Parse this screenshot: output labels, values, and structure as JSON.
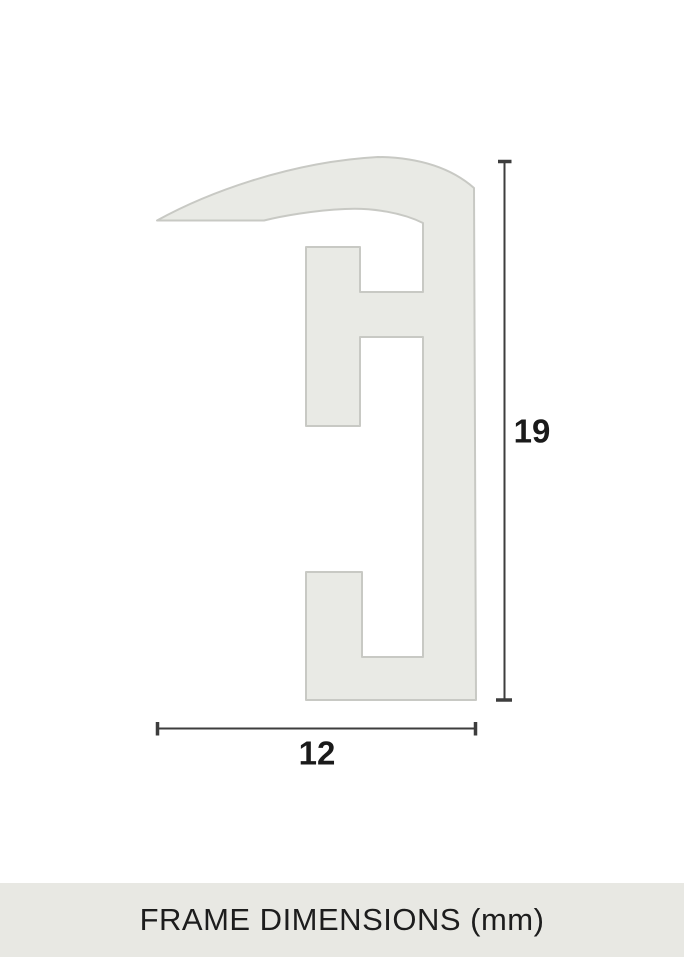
{
  "diagram": {
    "caption": "FRAME DIMENSIONS (mm)",
    "unit": "mm",
    "shape": "picture-frame-profile-cross-section",
    "dimensions": {
      "height": {
        "label": "19",
        "value": 19
      },
      "width": {
        "label": "12",
        "value": 12
      }
    }
  },
  "colors": {
    "background": "#ffffff",
    "profile_fill": "#e9eae5",
    "profile_stroke": "#c8c9c4",
    "dimension_line": "#3d3d3d",
    "label_text": "#1a1a1a",
    "footer_background": "#e8e8e3",
    "footer_text": "#1d1d1d"
  }
}
